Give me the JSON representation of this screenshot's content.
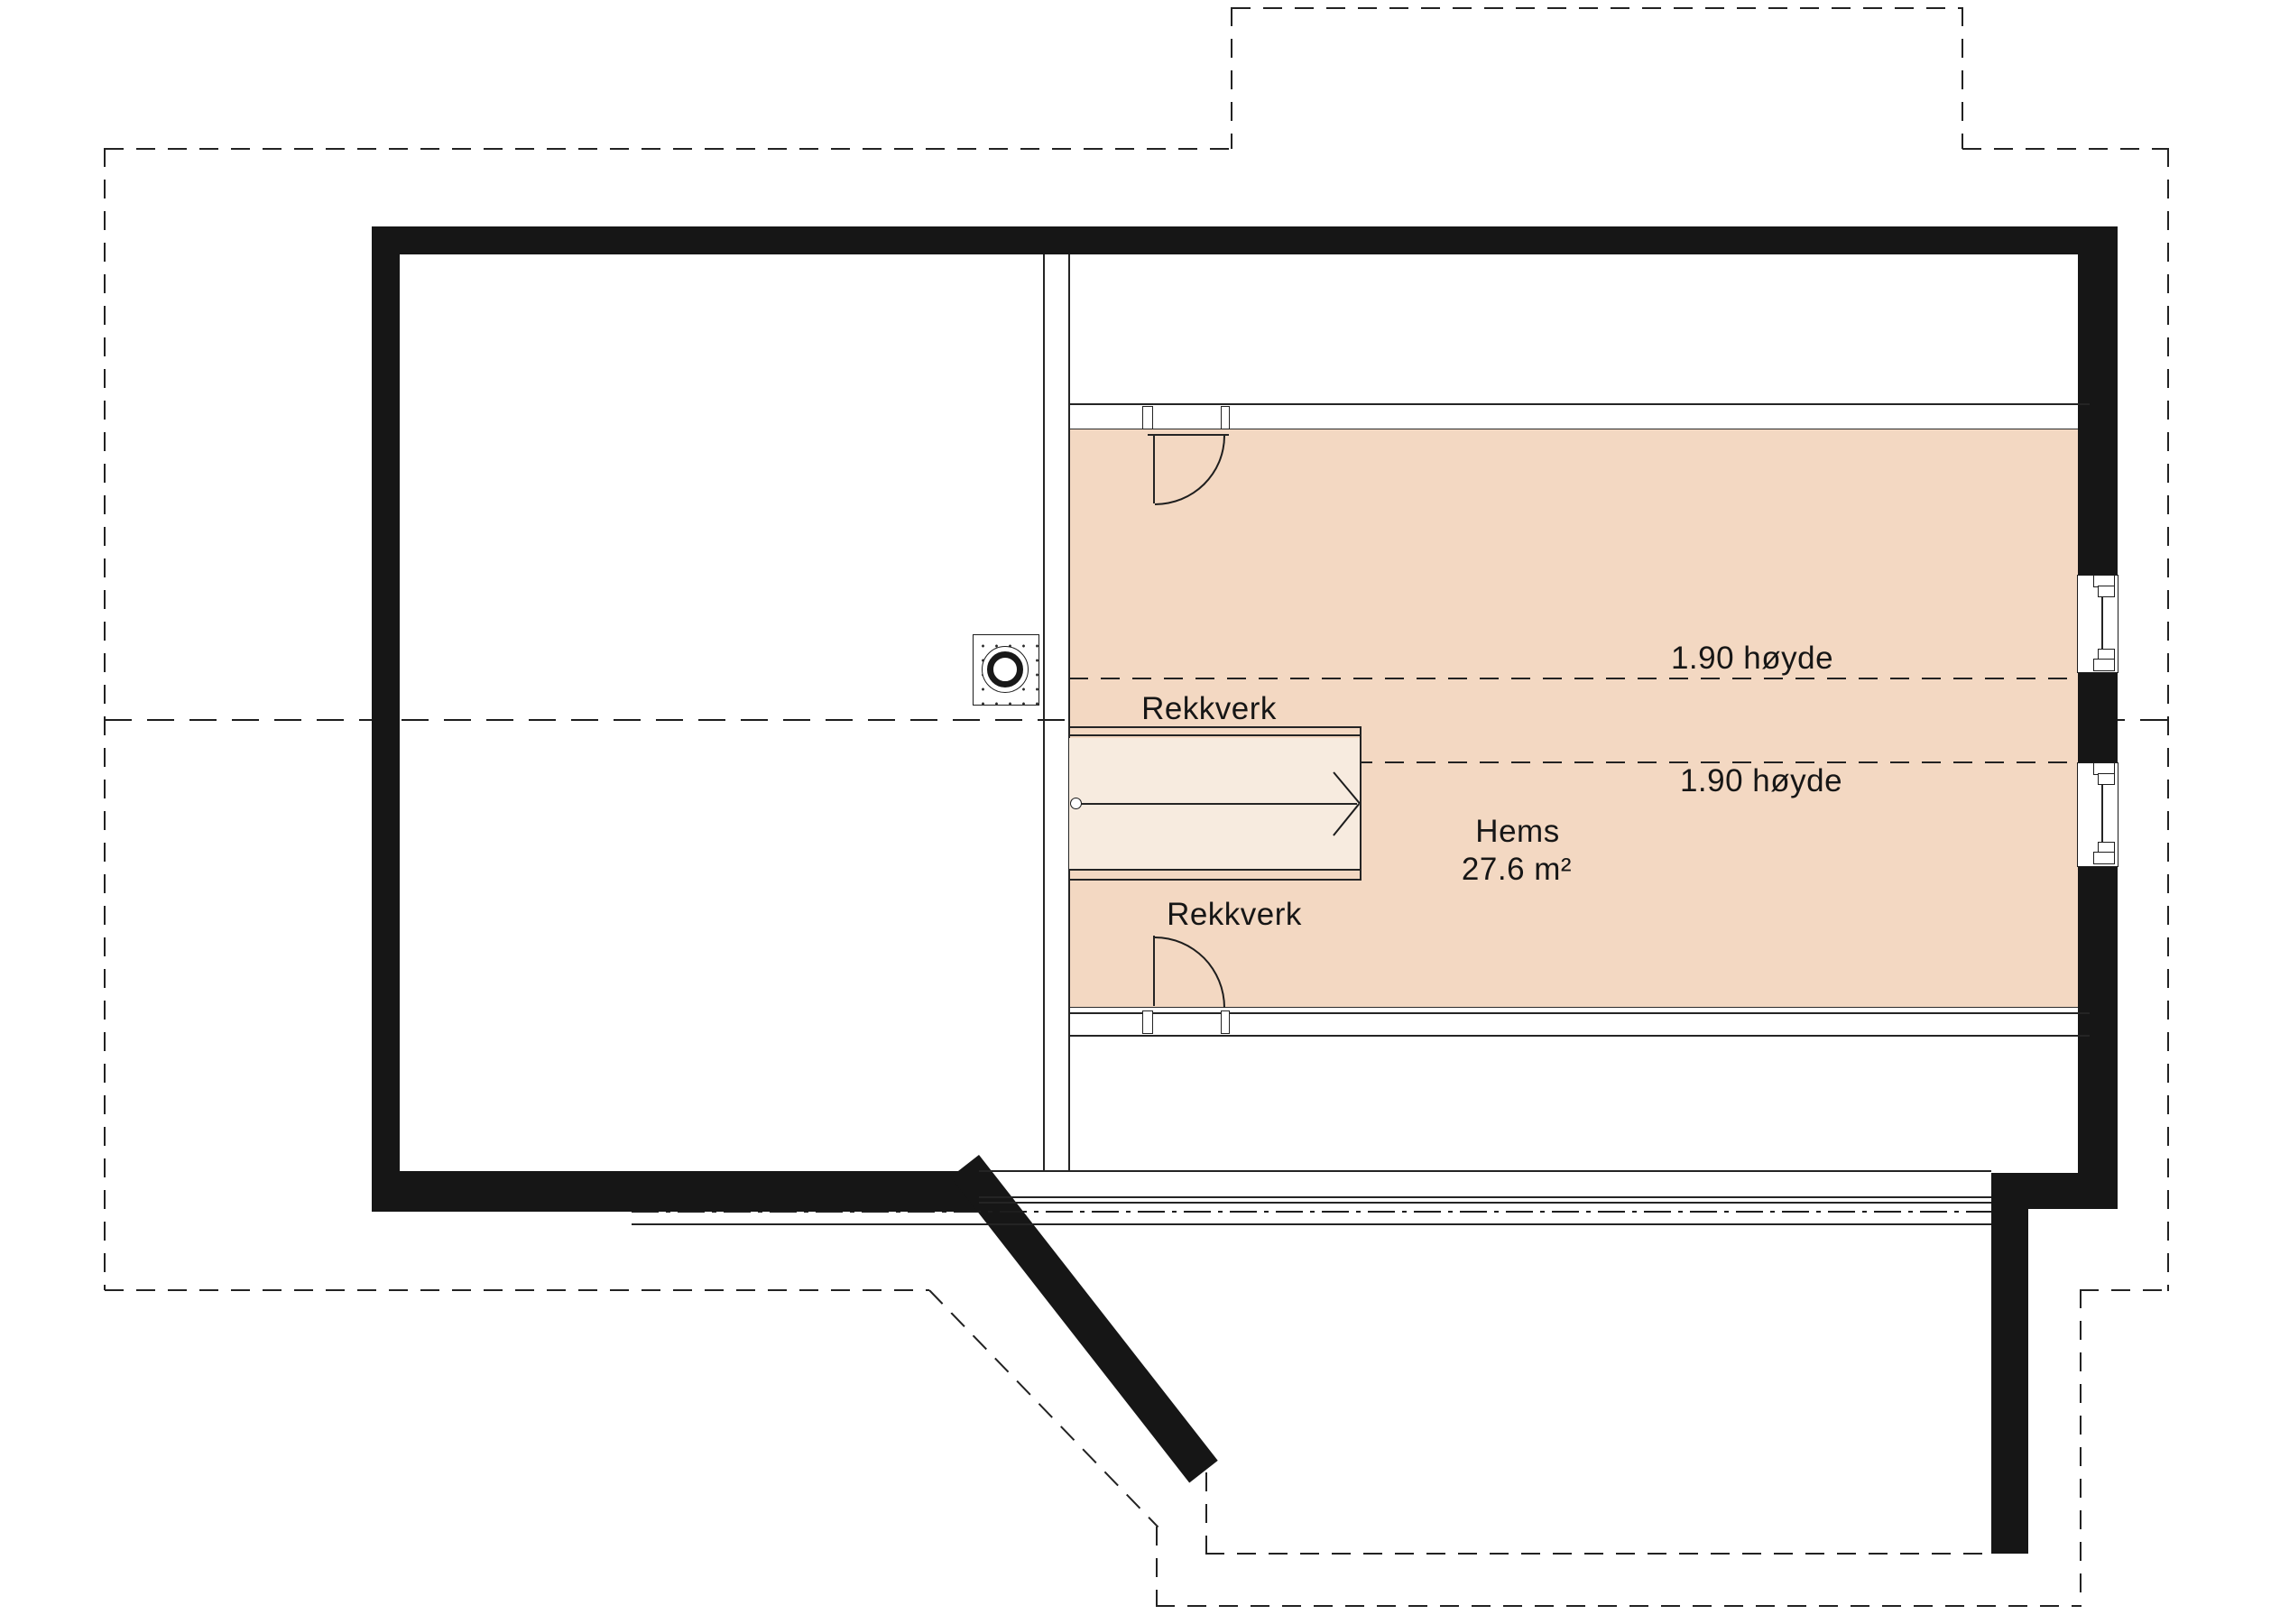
{
  "plan": {
    "title": "Hems floor plan",
    "room": {
      "name": "Hems",
      "area": "27.6 m²"
    },
    "labels": {
      "railing_top": "Rekkverk",
      "railing_bottom": "Rekkverk",
      "height_upper": "1.90 høyde",
      "height_lower": "1.90 høyde"
    },
    "colors": {
      "room_fill": "#f3d8c2",
      "stair_fill": "#f7ebdf",
      "wall": "#161616",
      "line": "#222222",
      "background": "#ffffff"
    }
  }
}
